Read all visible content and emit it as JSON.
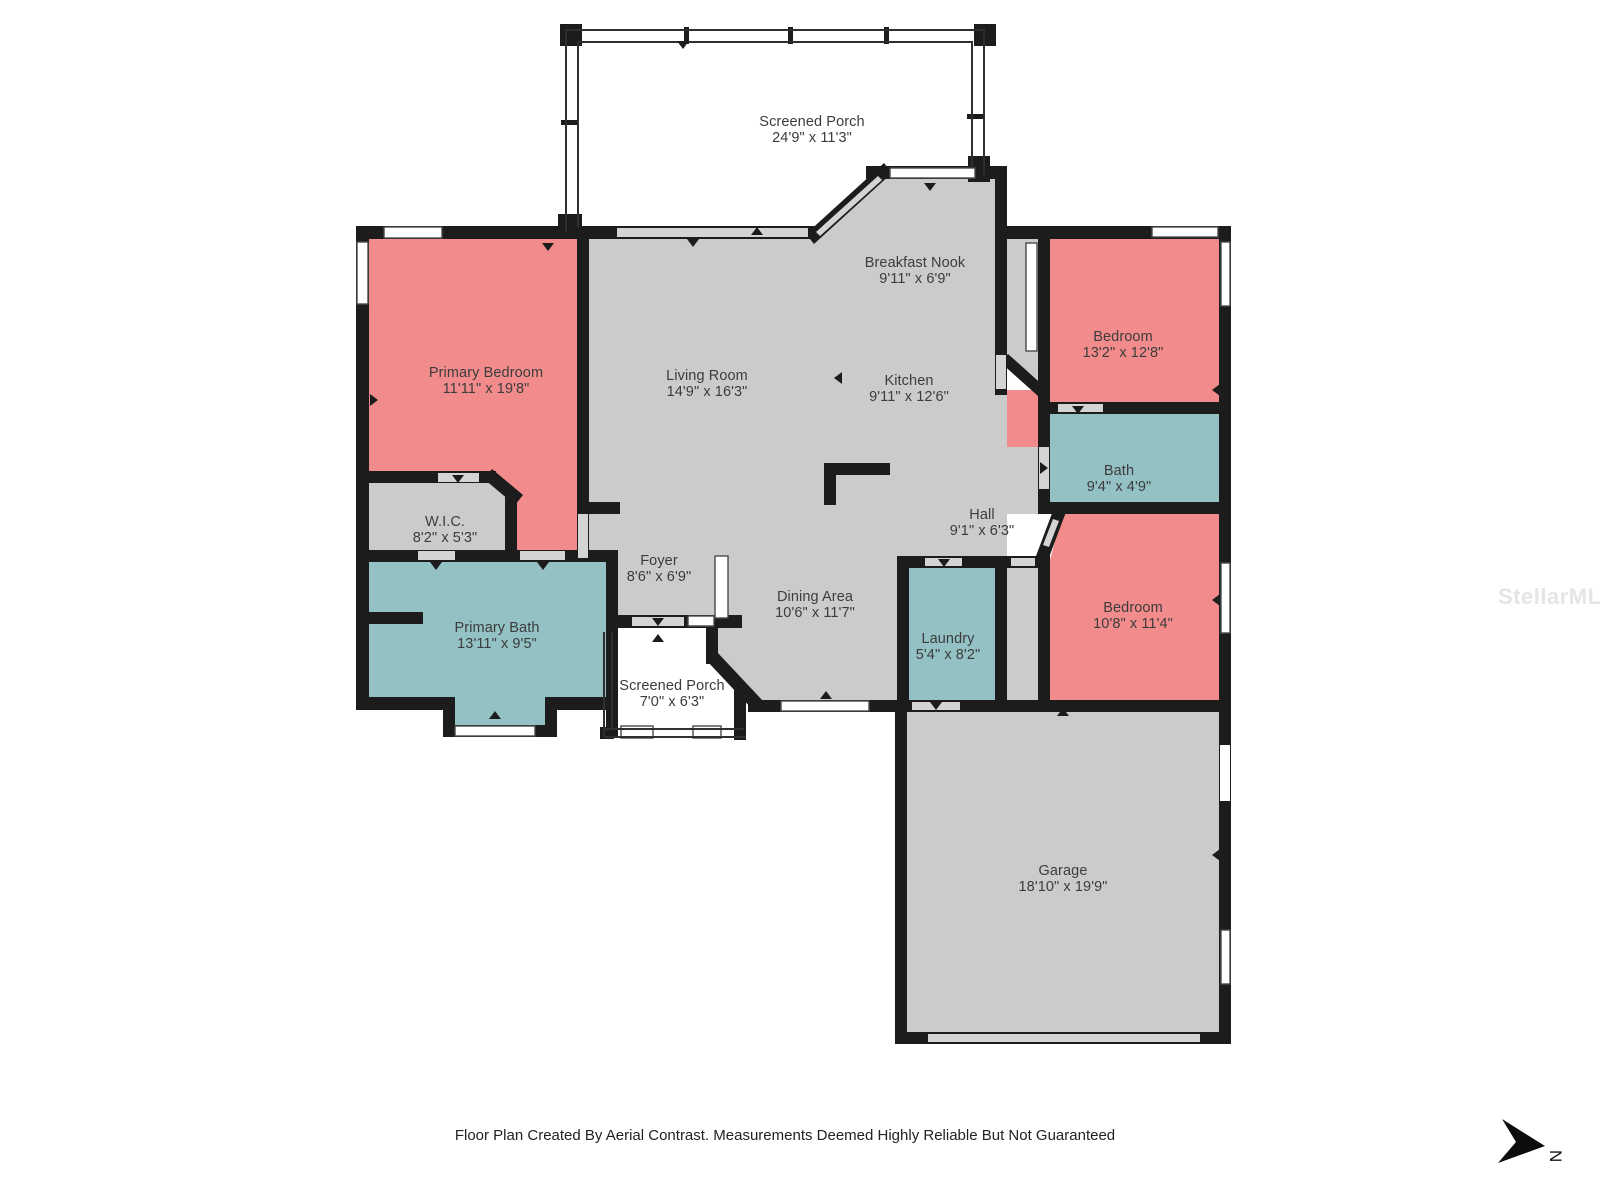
{
  "meta": {
    "footer": "Floor Plan Created By Aerial Contrast. Measurements Deemed Highly Reliable But Not Guaranteed",
    "watermark": "StellarMLS",
    "north_label": "N"
  },
  "colors": {
    "bedroom": "#F28C8C",
    "bath": "#93C1C4",
    "common": "#CBCBCB",
    "porch": "#FFFFFF",
    "wall": "#1C1C1C",
    "opening": "#D4D4D4",
    "window_frame": "#4A4A4A",
    "text": "#3C3C3C"
  },
  "rooms": [
    {
      "id": "screened-porch-top",
      "name": "Screened Porch",
      "dims": "24'9\" x 11'3\""
    },
    {
      "id": "primary-bedroom",
      "name": "Primary Bedroom",
      "dims": "11'11\" x 19'8\""
    },
    {
      "id": "living-room",
      "name": "Living Room",
      "dims": "14'9\" x 16'3\""
    },
    {
      "id": "breakfast-nook",
      "name": "Breakfast Nook",
      "dims": "9'11\" x 6'9\""
    },
    {
      "id": "kitchen",
      "name": "Kitchen",
      "dims": "9'11\" x 12'6\""
    },
    {
      "id": "bedroom-1",
      "name": "Bedroom",
      "dims": "13'2\" x 12'8\""
    },
    {
      "id": "bath",
      "name": "Bath",
      "dims": "9'4\" x 4'9\""
    },
    {
      "id": "hall",
      "name": "Hall",
      "dims": "9'1\" x 6'3\""
    },
    {
      "id": "wic",
      "name": "W.I.C.",
      "dims": "8'2\" x 5'3\""
    },
    {
      "id": "foyer",
      "name": "Foyer",
      "dims": "8'6\" x 6'9\""
    },
    {
      "id": "dining-area",
      "name": "Dining Area",
      "dims": "10'6\" x 11'7\""
    },
    {
      "id": "primary-bath",
      "name": "Primary Bath",
      "dims": "13'11\" x 9'5\""
    },
    {
      "id": "laundry",
      "name": "Laundry",
      "dims": "5'4\" x 8'2\""
    },
    {
      "id": "bedroom-2",
      "name": "Bedroom",
      "dims": "10'8\" x 11'4\""
    },
    {
      "id": "screened-porch-small",
      "name": "Screened Porch",
      "dims": "7'0\" x 6'3\""
    },
    {
      "id": "garage",
      "name": "Garage",
      "dims": "18'10\" x 19'9\""
    }
  ]
}
